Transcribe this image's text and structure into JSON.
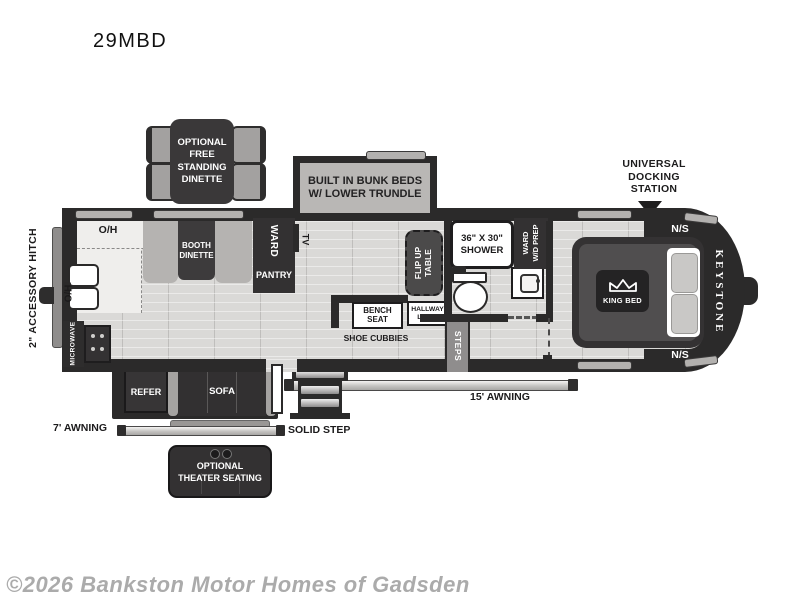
{
  "title": "29MBD",
  "watermark": "©2026 Bankston Motor Homes of Gadsden",
  "colors": {
    "wall": "#2b2a2a",
    "floor": "#dad9d7",
    "slide_gray": "#b9b7b5",
    "furniture_dark": "#333132",
    "white_fixture": "#ffffff",
    "watermark_gray": "#ababab"
  },
  "annotations": {
    "docking_station": "UNIVERSAL\nDOCKING\nSTATION",
    "accessory_hitch": "2\" ACCESSORY HITCH",
    "awning_front": "7' AWNING",
    "awning_main": "15' AWNING",
    "solid_step": "SOLID STEP"
  },
  "options": {
    "free_standing_dinette": "OPTIONAL\nFREE\nSTANDING\nDINETTE",
    "theater_seating": "OPTIONAL\nTHEATER SEATING"
  },
  "exterior_labels": {
    "ns_top": "N/S",
    "ns_bottom": "N/S",
    "brand": "KEYSTONE"
  },
  "interior": {
    "bunks": "BUILT IN BUNK BEDS\nW/ LOWER TRUNDLE",
    "oh_top": "O/H",
    "oh_side": "O/H",
    "microwave": "MICROWAVE",
    "booth_dinette": "BOOTH\nDINETTE",
    "ward": "WARD",
    "pantry": "PANTRY",
    "tv": "TV",
    "flip_up_table": "FLIP UP\nTABLE",
    "bench_seat": "BENCH\nSEAT",
    "hallway_linen": "HALLWAY\nLINEN",
    "shoe_cubbies": "SHOE CUBBIES",
    "steps": "STEPS",
    "shower": "36\" X 30\"\nSHOWER",
    "ward_wd_prep": "WARD\nW/D PREP",
    "king_bed": "KING BED",
    "refer": "REFER",
    "sofa": "SOFA"
  }
}
